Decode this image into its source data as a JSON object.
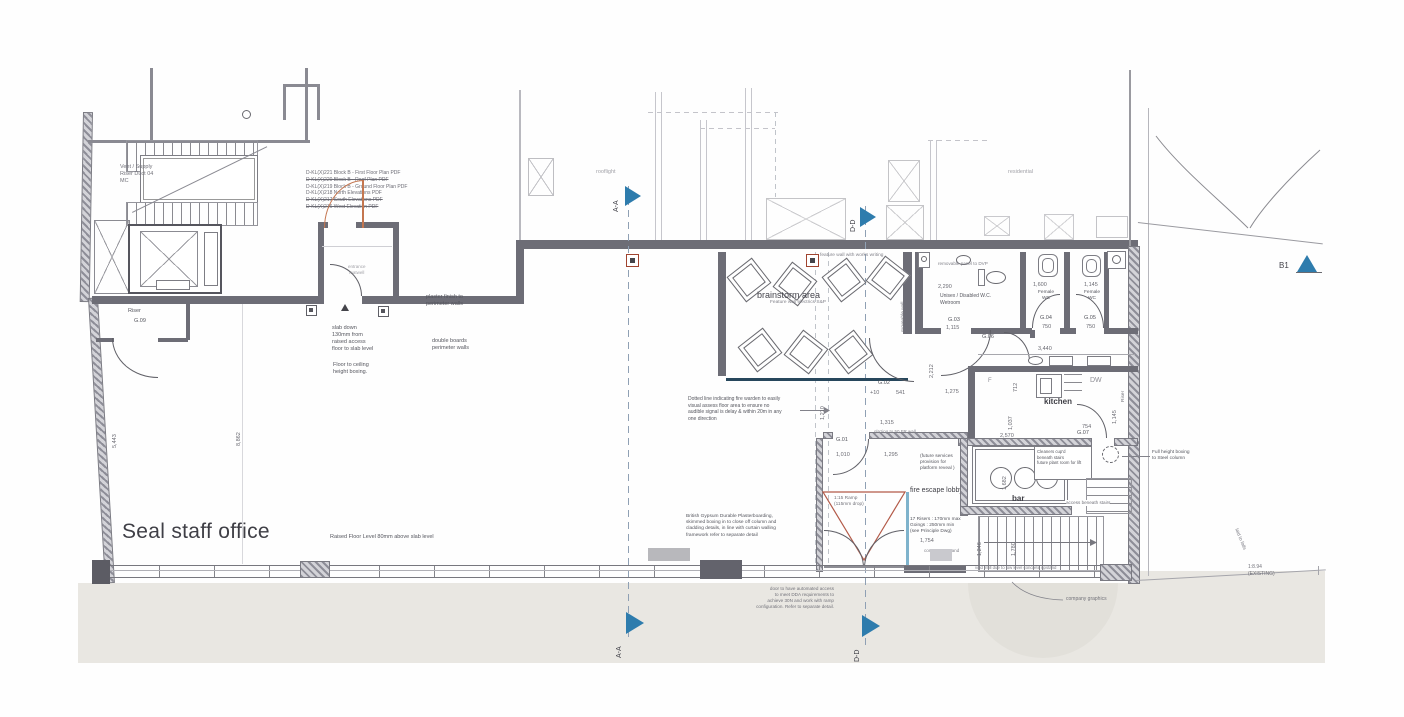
{
  "colors": {
    "accent_blue": "#2e7cad",
    "door_orange": "#c4764f",
    "ramp_red": "#b35a48",
    "wall_gray": "#6d6d76",
    "glazing_teal": "#27475c",
    "glazing_blue": "#7fb3cc"
  },
  "rooms": {
    "office": "Seal staff office",
    "brainstorm": "brainstorm area",
    "kitchen": "kitchen",
    "bar": "bar",
    "fire_lobby": "fire escape lobby",
    "wetroom": "Unisex / Disabled W.C.\nWetroom",
    "female_wc_1": "Female\nWC",
    "female_wc_2": "Female\nWC",
    "riser": "Riser",
    "riser_side": "Riser",
    "moveable_wall": "moveable wall",
    "residential": "residential",
    "rooflight": "rooflight",
    "dishwasher": "DW",
    "fridge": "F",
    "entrance_mat": "entrance\nmatwell"
  },
  "room_ids": {
    "g01": "G.01",
    "g02": "G.02",
    "g03": "G.03",
    "g04": "G.04",
    "g05": "G.05",
    "g06": "G.06",
    "g07": "G.07",
    "g09": "G.09"
  },
  "drawing_list": [
    "D-KL(X)221 Block B - First Floor Plan PDF",
    "D-KL(X)220 Block B - Roof Plan PDF",
    "D-KL(X)219 Block B - Ground Floor Plan PDF",
    "D-KL(X)218 North Elevations PDF",
    "D-KL(X)217 South Elevations PDF",
    "D-KL(X)216 West Elevation PDF"
  ],
  "annotations": {
    "vent_duct": "Vent / Supply\nRiser Duct 04\nMC",
    "slab_down": "slab down\n130mm from\nraised access\nfloor to slab level",
    "floor_ceiling": "Floor to ceiling\nheight boxing.",
    "plaster_finish": "plaster finish to\nperimeter walls",
    "double_boards": "double boards\nperimeter walls",
    "raised_floor": "Raised Floor Level 80mm above slab level",
    "fire_warden": "Dotted line indicating fire warden to easily\nvisual assess floor area to ensure no\naudible signal is delay & within 20m in any\none direction",
    "feature_wall": "Feature wall electrics S&P",
    "feature_wall_writing": "feature wall with works writing",
    "removable_panel": "removable panel to DVP",
    "glazing_fr": "glazing to 50 FR wall",
    "future_services": "(future services\nprovision for\nplatform reveal )",
    "ramp": "1:15 Ramp\n(115mm drop)",
    "stair_note": "17 Risers : 170mm max\nGoings : 250mm min\n(see Principle Dwg)",
    "gypsum": "British Gypsum Durable Plasterboarding,\nskimmed boxing in to close off column and\ncladding details, in line with curtain walling\nframework refer to separate detail",
    "cleaners": "Cleaners cup'd\nbeneath stairs\nfuture plant room for lift",
    "boxing_steel": "Full height boxing\nto Steel column",
    "access_stairs": "access beneath stairs",
    "void_infill": "void infill due to low level concrete upstand",
    "concrete_upstand": "concrete upstand",
    "company_graphics": "company graphics",
    "dda": "door to have automated access\nto meet DDA requirements to\nachieve 30N and work with ramp\nconfiguration. Refer to separate detail.",
    "slope_existing": "1:8.94\n(EXISTING)",
    "laid_to_falls": "laid to falls"
  },
  "dimensions": {
    "wet_w": "2,290",
    "wc4_w": "1,600",
    "wc5_w": "1,145",
    "wc4_d": "750",
    "wc5_d": "750",
    "g03_w": "1,115",
    "corr": "3,440",
    "g02_a": "+10",
    "g02_b": "541",
    "g02_c": "1,275",
    "v2212": "2,212",
    "v715": "715",
    "v712": "712",
    "lobby_w": "1,315",
    "d1010": "1,010",
    "d1295": "1,295",
    "v1210": "1,210",
    "v1037": "1,037",
    "v1145": "1,145",
    "d2570": "2,570",
    "d754": "754",
    "v1682": "1,682",
    "d1754": "1,754",
    "v1246": "1,246",
    "v1780": "1,780",
    "v8862": "8,862",
    "v5443": "5,443"
  },
  "markers": {
    "aa": "A-A",
    "dd": "D-D",
    "b1": "B1"
  }
}
